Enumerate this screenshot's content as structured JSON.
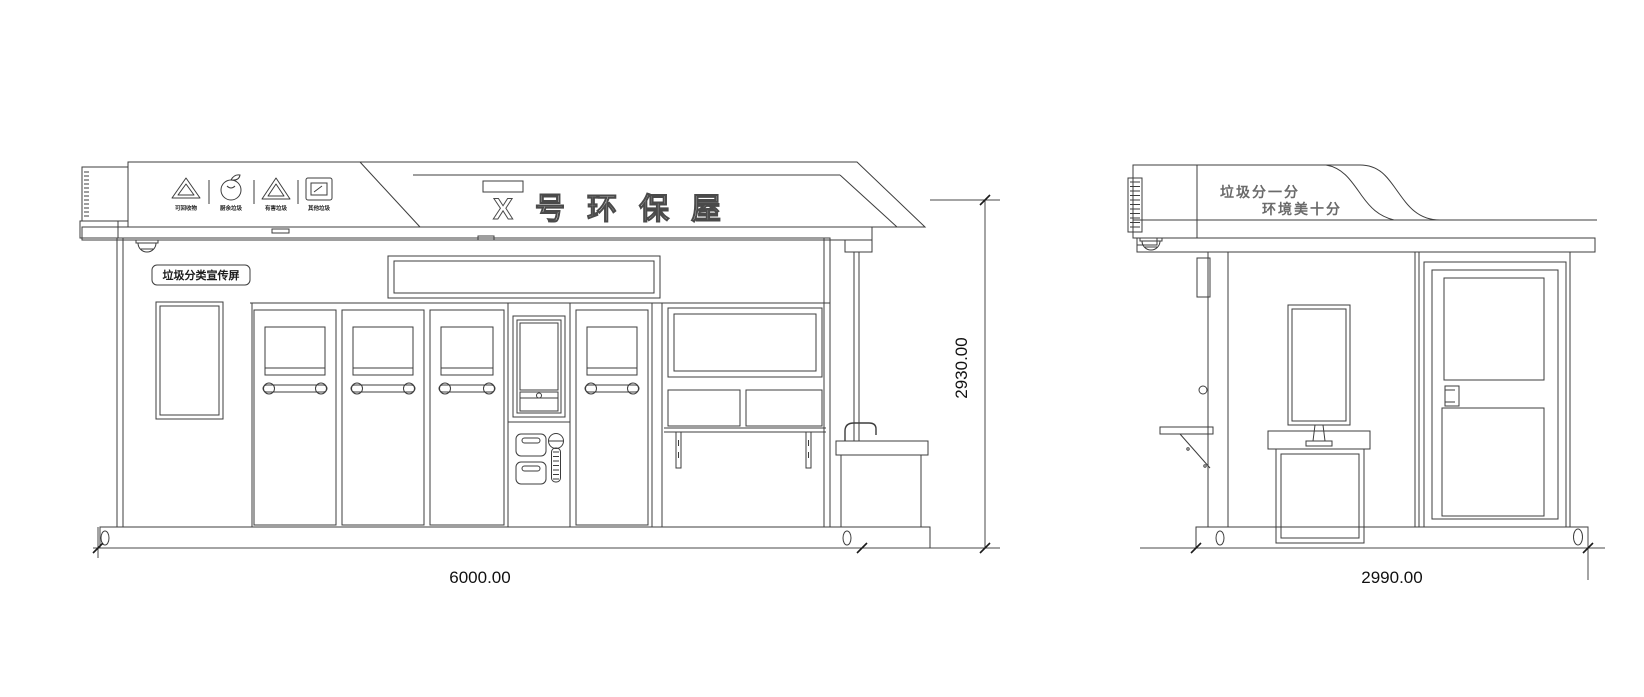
{
  "front": {
    "view_name": "front-elevation",
    "signboard": {
      "title": "X号环保屋",
      "icons": [
        {
          "name": "recyclable-icon",
          "label": "可回收物"
        },
        {
          "name": "kitchen-waste-icon",
          "label": "厨余垃圾"
        },
        {
          "name": "hazardous-waste-icon",
          "label": "有害垃圾"
        },
        {
          "name": "other-waste-icon",
          "label": "其他垃圾"
        }
      ]
    },
    "screen_label": "垃圾分类宣传屏",
    "dim_width": "6000.00",
    "dim_height": "2930.00"
  },
  "side": {
    "view_name": "side-elevation",
    "slogan_line1": "垃圾分一分",
    "slogan_line2": "环境美十分",
    "dim_depth": "2990.00"
  },
  "colors": {
    "line": "#3d3d3d",
    "dim_text": "#111111",
    "background": "#ffffff"
  }
}
